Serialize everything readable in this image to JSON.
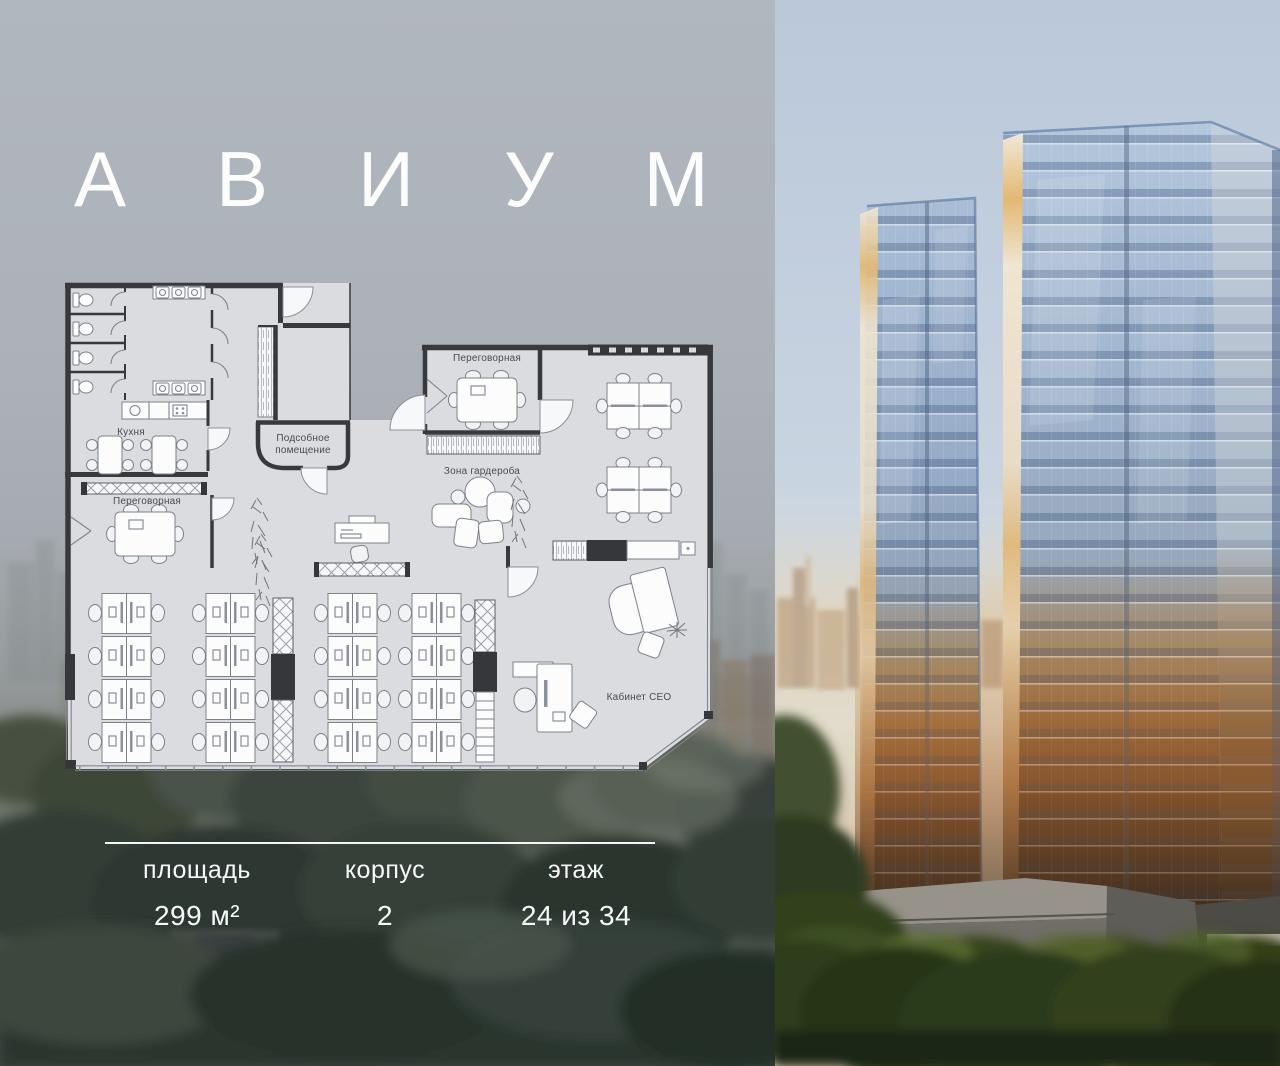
{
  "brand": {
    "name": "АВИУМ"
  },
  "floor_plan": {
    "labels": {
      "kitchen": "Кухня",
      "meeting_left": "Переговорная",
      "meeting_top": "Переговорная",
      "utility_1": "Подсобное",
      "utility_2": "помещение",
      "wardrobe": "Зона гардероба",
      "ceo_office": "Кабинет CEO"
    }
  },
  "info_panel": {
    "fields": [
      {
        "id": "area",
        "label": "площадь",
        "value": "299 м²"
      },
      {
        "id": "building",
        "label": "корпус",
        "value": "2"
      },
      {
        "id": "floor",
        "label": "этаж",
        "value": "24 из 34"
      }
    ]
  },
  "colors": {
    "overlay_top": "#b1b7bf",
    "overlay_bottom": "#3e4740",
    "plan_floor": "#dadce0",
    "plan_wall": "#38393d",
    "sky_top": "#b7c6d8",
    "glass_blue": "#8ea7c8",
    "sunset_amber": "#b97f45",
    "trees_dark": "#27331b",
    "text_light": "#ffffff"
  }
}
